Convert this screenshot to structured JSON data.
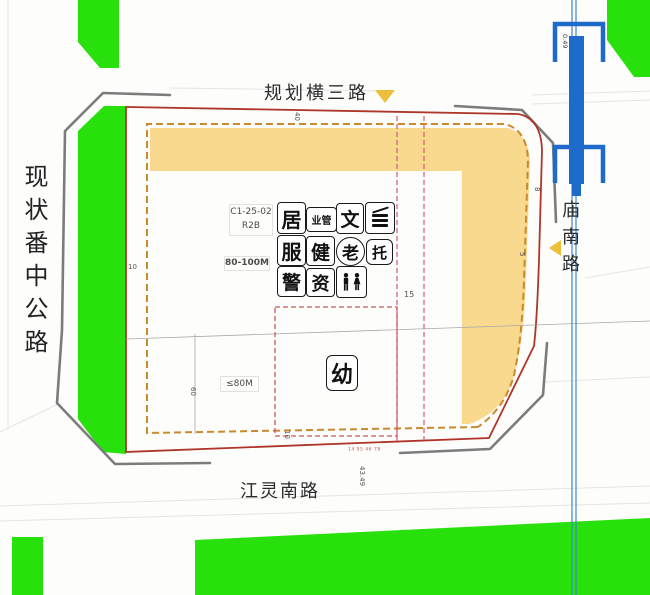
{
  "plan": {
    "roads": {
      "top": "规划横三路",
      "left": "现状番中公路",
      "bottom": "江灵南路",
      "right": "庙南路"
    },
    "parcel": {
      "code": "C1-25-02",
      "land_use_code": "R2B",
      "height_limit_north": "80-100M",
      "height_limit_south": "≤80M",
      "kindergarten": "幼"
    },
    "facilities": {
      "residential": "居",
      "business_mgmt": "业管",
      "culture": "文",
      "service": "服",
      "health": "健",
      "elderly": "老",
      "nursery": "托",
      "police": "警",
      "recycling": "资"
    },
    "dimensions": {
      "road_top": "40",
      "setback_left": "10",
      "setback_right_upper": "8",
      "setback_right_lower": "5",
      "center_offset": "15",
      "parcel_depth": "60",
      "setback_bottom": "10",
      "chainage_bottom": "43.49",
      "chainage_bridge": "0.49",
      "red_line_note": "14 95 46 78"
    },
    "colors": {
      "green_space": "#28e10c",
      "commercial_band": "#f8d98d",
      "setback_dash": "#c98a2e",
      "red_line": "#ae3529",
      "control_dash": "#dd6080",
      "water_blue": "#1e6bcc",
      "road_gray": "#7c7c7c",
      "marker_yellow": "#ecbe3a"
    }
  }
}
